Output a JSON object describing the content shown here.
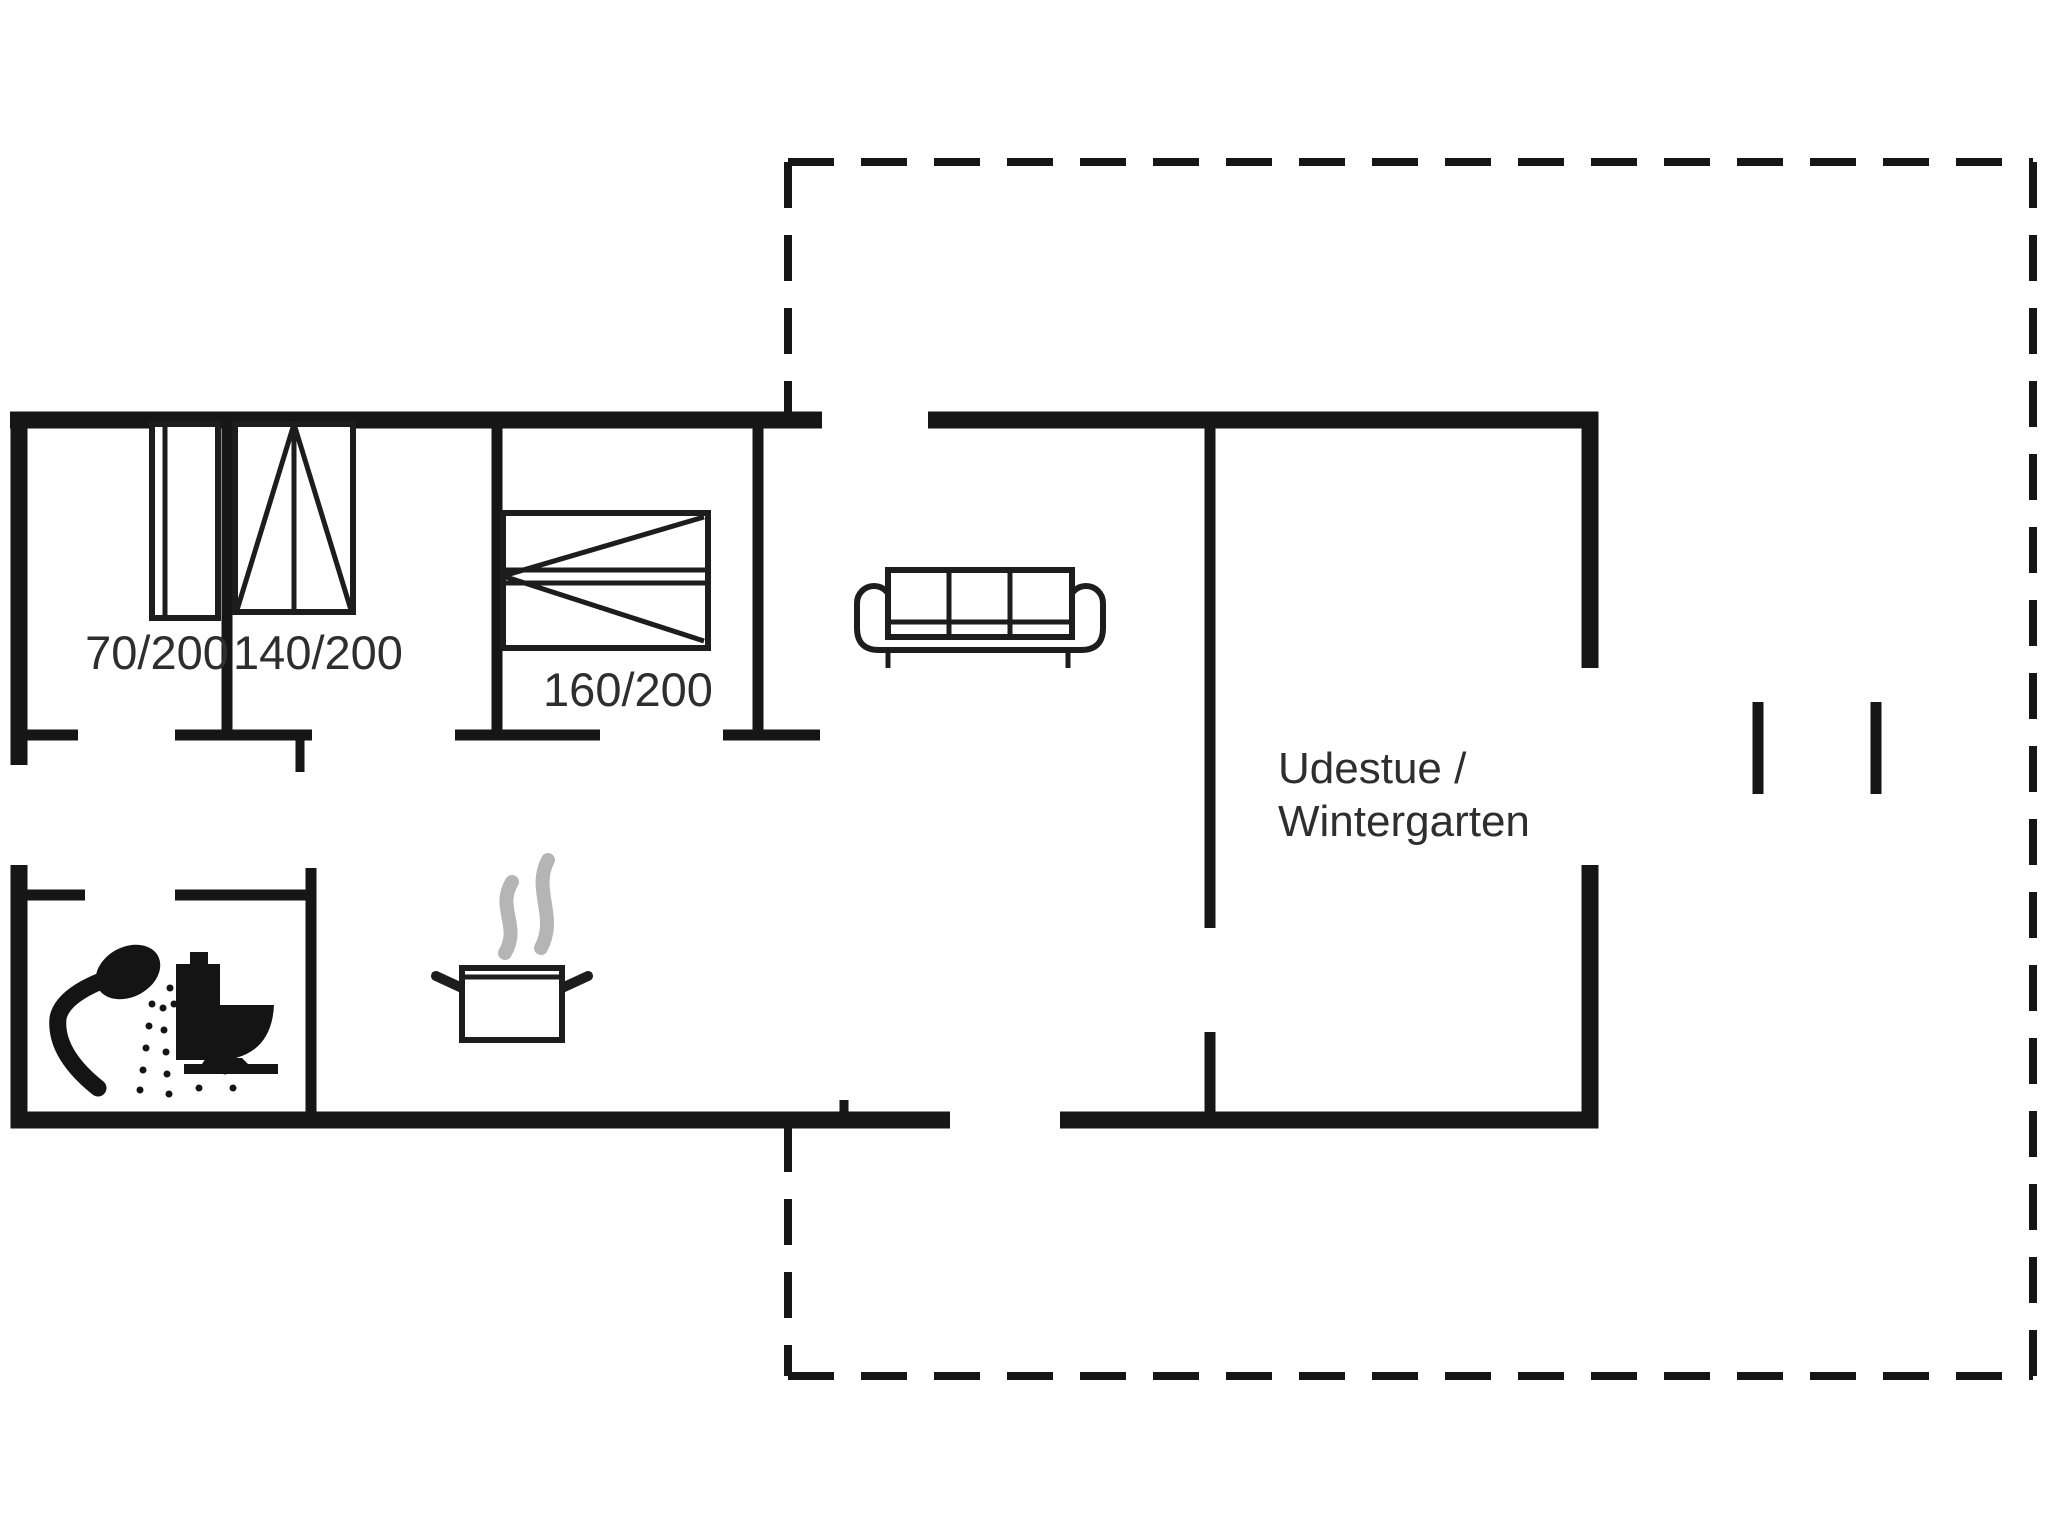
{
  "floorplan": {
    "colors": {
      "background": "#ffffff",
      "ink": "#161616",
      "label_text": "#2e2e2e",
      "steam": "#b5b5b5"
    },
    "beds": [
      {
        "label": "70/200"
      },
      {
        "label": "140/200"
      },
      {
        "label": "160/200"
      }
    ],
    "room": {
      "name_line1": "Udestue /",
      "name_line2": "Wintergarten"
    },
    "icons": {
      "shower": "shower-icon",
      "toilet": "toilet-icon",
      "cooking_pot": "cooking-pot-icon",
      "steam": "steam-icon",
      "sofa": "sofa-icon",
      "window_markers": "window-marker-icon",
      "terrace_boundary": "dashed-boundary"
    }
  }
}
